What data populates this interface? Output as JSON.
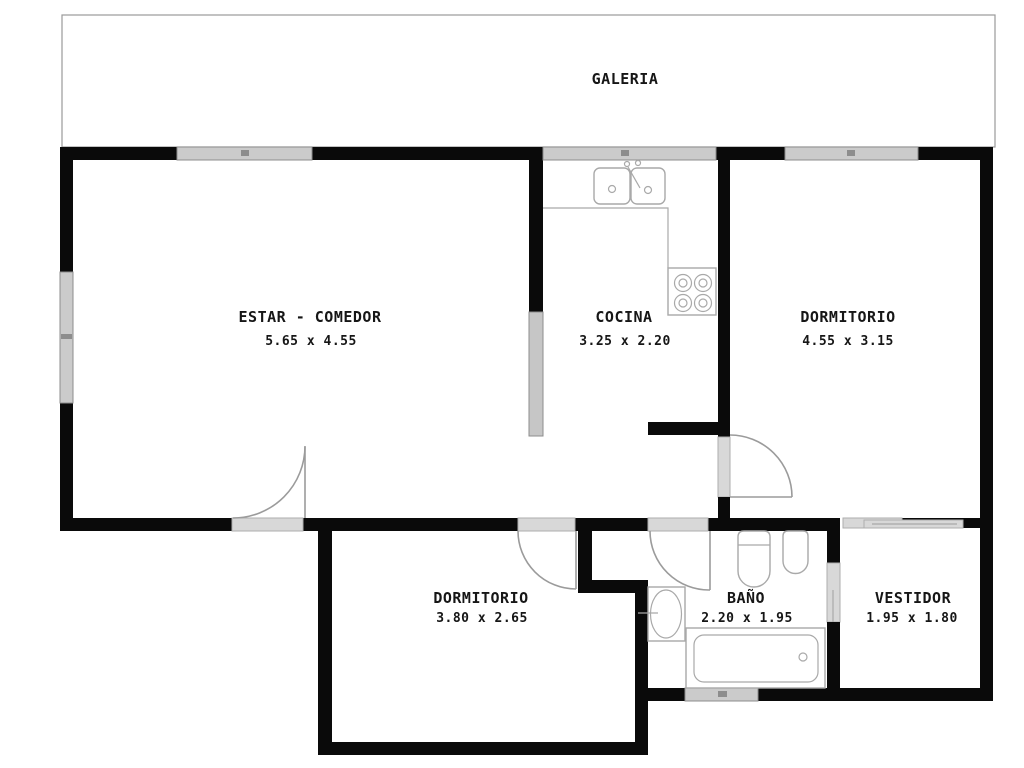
{
  "galeria": {
    "label": "GALERIA"
  },
  "rooms": {
    "estar": {
      "label": "ESTAR - COMEDOR",
      "dims": "5.65 x 4.55"
    },
    "cocina": {
      "label": "COCINA",
      "dims": "3.25 x 2.20"
    },
    "dormitorio1": {
      "label": "DORMITORIO",
      "dims": "4.55 x 3.15"
    },
    "dormitorio2": {
      "label": "DORMITORIO",
      "dims": "3.80 x 2.65"
    },
    "bano": {
      "label": "BAÑO",
      "dims": "2.20 x 1.95"
    },
    "vestidor": {
      "label": "VESTIDOR",
      "dims": "1.95 x 1.80"
    }
  },
  "colors": {
    "wall": "#0a0a0a",
    "window-fill": "#cbcbcb",
    "window-border": "#8d8d8d",
    "opening-fill": "#d8d8d8",
    "opening-border": "#aeaeae",
    "low-wall-fill": "#c6c6c6",
    "door-line": "#9b9b9b",
    "fixture-line": "#a9a9a9",
    "outline": "#9a9a9a",
    "text": "#161616",
    "background": "#ffffff"
  }
}
